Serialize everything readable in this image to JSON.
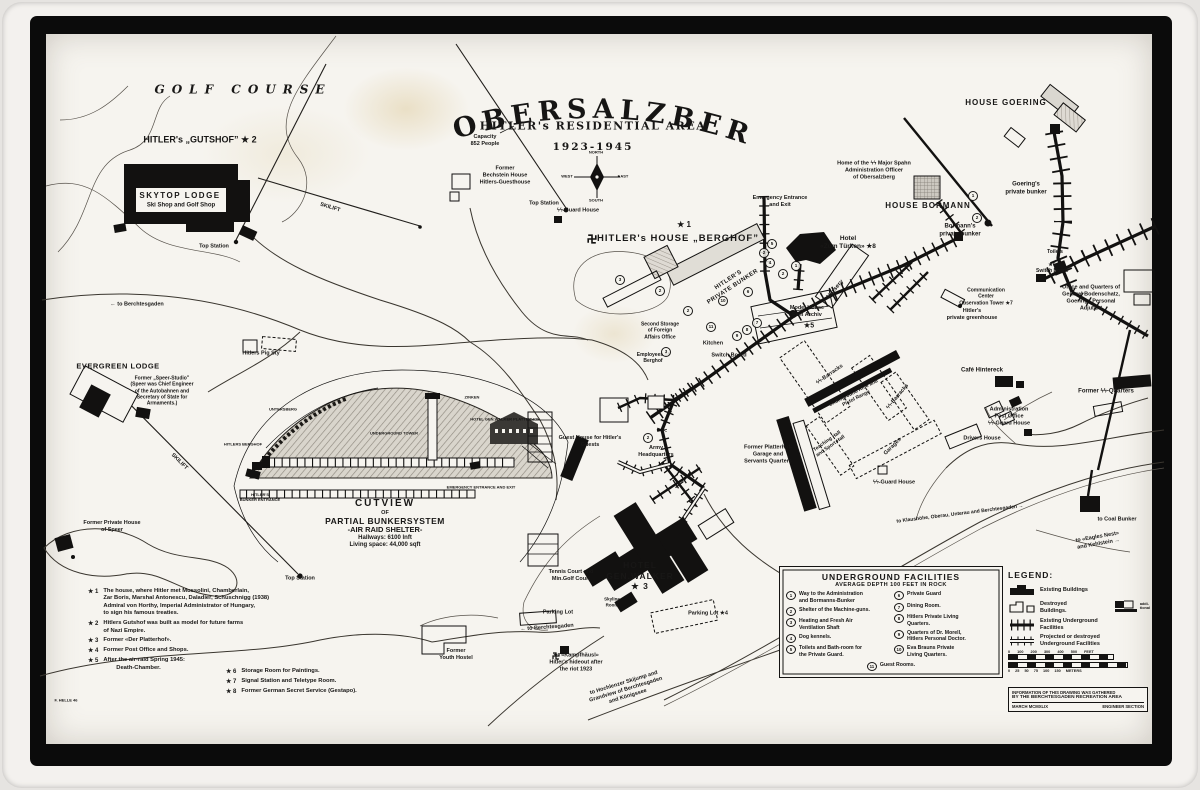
{
  "title": {
    "main": "OBERSALZBERG",
    "sub": "HITLER's RESIDENTIAL AREA",
    "years": "1923-1945"
  },
  "cutview": {
    "l1": "CUTVIEW",
    "l2": "OF",
    "l3": "PARTIAL BUNKERSYSTEM",
    "l4": "-AIR RAID SHELTER-",
    "l5": "Hallways: 6100 lnft",
    "l6": "Living space: 44,000 sqft"
  },
  "underground_facilities": {
    "title": "UNDERGROUND FACILITIES",
    "subtitle": "AVERAGE DEPTH 100 FEET IN ROCK",
    "left": [
      {
        "num": "1",
        "text": "Way to the Administration\nand Bormanns-Bunker"
      },
      {
        "num": "2",
        "text": "Shelter of the Machine-guns."
      },
      {
        "num": "3",
        "text": "Heating and Fresh Air\nVentilation Shaft"
      },
      {
        "num": "4",
        "text": "Dog kennels."
      },
      {
        "num": "5",
        "text": "Toilets and Bath-room for\nthe Private Guard."
      }
    ],
    "right": [
      {
        "num": "6",
        "text": "Private Guard"
      },
      {
        "num": "7",
        "text": "Dining Room."
      },
      {
        "num": "8",
        "text": "Hitlers Private Living\nQuarters."
      },
      {
        "num": "9",
        "text": "Quarters of Dr. Morell,\nHitlers Personal Doctor."
      },
      {
        "num": "10",
        "text": "Eva Brauns Private\nLiving Quarters."
      }
    ],
    "bottom": {
      "num": "11",
      "text": "Guest Rooms."
    }
  },
  "footnotes": {
    "left": [
      {
        "mark": "★ 1",
        "text": "The house, where Hitler met Mussolini, Chamberlain,\nZar Boris, Marshal Antonescu, Daladier, Schuschnigg (1938)\nAdmiral von Horthy, Imperial Administrator of Hungary,\nto sign his famous treaties."
      },
      {
        "mark": "★ 2",
        "text": "Hitlers Gutshof was built as model for future farms\nof Nazi Empire."
      },
      {
        "mark": "★ 3",
        "text": "Former «Der Platterhof»."
      },
      {
        "mark": "★ 4",
        "text": "Former Post Office and Shops."
      },
      {
        "mark": "★ 5",
        "text": "After the air-raid Spring 1945:\n        Death-Chamber."
      }
    ],
    "right": [
      {
        "mark": "★ 6",
        "text": "Storage Room for Paintings."
      },
      {
        "mark": "★ 7",
        "text": "Signal Station and Teletype Room."
      },
      {
        "mark": "★ 8",
        "text": "Former German Secret Service (Gestapo)."
      }
    ]
  },
  "legend": {
    "title": "LEGEND:",
    "existing": "Existing Buildings",
    "destroyed": "Destroyed\nBuildings.",
    "additional_note": "addi-\ntional",
    "underground": "Existing Underground\nFacilities",
    "projected": "Projected or destroyed\nUnderground Facilities",
    "scale_feet": "0 100 200 300 400 500 FEET",
    "scale_meters": "0 25 50 75 100 150 METERS"
  },
  "credit": {
    "line1": "INFORMATION OF THIS DRAWING WAS GATHERED",
    "line2": "BY THE BERCHTESGADEN RECREATION AREA",
    "line3_left": "MARCH MCMXLIX",
    "line3_right": "ENGINEER SECTION"
  },
  "map_labels": [
    {
      "n": "golf-course-label",
      "t": "GOLF COURSE",
      "x": 243,
      "y": 90,
      "s": 12,
      "ls": 7,
      "i": 1,
      "b": 1
    },
    {
      "n": "hitlers-gutshof-label",
      "t": "HITLER's „GUTSHOF” ★ 2",
      "x": 200,
      "y": 140,
      "s": 9,
      "b": 1
    },
    {
      "n": "skytop-lodge-label",
      "t": "SKYTOP LODGE",
      "x": 180,
      "y": 196,
      "s": 8,
      "b": 1,
      "ls": 1.5
    },
    {
      "n": "skytop-lodge-sub",
      "t": "Ski Shop and Golf Shop",
      "x": 181,
      "y": 206,
      "s": 6,
      "b": 1
    },
    {
      "n": "top-station-nw",
      "t": "Top Station",
      "x": 214,
      "y": 247,
      "s": 5.5
    },
    {
      "n": "skilift-ne-label",
      "t": "SKILIFT",
      "x": 330,
      "y": 208,
      "s": 5.5,
      "r": 17
    },
    {
      "n": "capacity-note",
      "t": "Capacity\n852 People",
      "x": 485,
      "y": 141,
      "s": 5.5
    },
    {
      "n": "bechstein-house-label",
      "t": "Former\nBechstein House\nHitlers-Guesthouse",
      "x": 505,
      "y": 176,
      "s": 5.5
    },
    {
      "n": "top-station-center",
      "t": "Top Station",
      "x": 544,
      "y": 204,
      "s": 5.5
    },
    {
      "n": "ss-guard-house-berghof",
      "t": "ϟϟ-Guard House",
      "x": 578,
      "y": 211,
      "s": 5.5
    },
    {
      "n": "berghof-star",
      "t": "★ 1",
      "x": 684,
      "y": 225,
      "s": 8,
      "b": 1
    },
    {
      "n": "berghof-label",
      "t": "HITLER's HOUSE „BERGHOF”",
      "x": 678,
      "y": 239,
      "s": 9.5,
      "b": 1,
      "ls": 1
    },
    {
      "n": "hitlers-private-bunker-label",
      "t": "HITLER'S\nPRIVATE BUNKER",
      "x": 731,
      "y": 284,
      "s": 6,
      "r": -33,
      "ls": 0.5
    },
    {
      "n": "emergency-entrance-label",
      "t": "Emergency Entrance\nand Exit",
      "x": 780,
      "y": 202,
      "s": 5.5
    },
    {
      "n": "spahn-home-label",
      "t": "Home of the ϟϟ Major Spahn\nAdministration Officer\nof Obersalzberg",
      "x": 874,
      "y": 171,
      "s": 5.5
    },
    {
      "n": "house-goering-label",
      "t": "HOUSE GOERING",
      "x": 1006,
      "y": 103,
      "s": 8,
      "b": 1,
      "ls": 1
    },
    {
      "n": "goerings-bunker-label",
      "t": "Goering's\nprivate bunker",
      "x": 1026,
      "y": 189,
      "s": 6
    },
    {
      "n": "house-bormann-label",
      "t": "HOUSE BORMANN",
      "x": 928,
      "y": 206,
      "s": 8,
      "b": 1,
      "ls": 1
    },
    {
      "n": "bormanns-bunker-label",
      "t": "Bormann's\nprivate bunker",
      "x": 960,
      "y": 231,
      "s": 6
    },
    {
      "n": "toilets-label",
      "t": "Toilets",
      "x": 1055,
      "y": 252,
      "s": 5
    },
    {
      "n": "switchboard-6-label",
      "t": "★6\nSwitch Board",
      "x": 1052,
      "y": 268,
      "s": 5
    },
    {
      "n": "bodenschatz-label",
      "t": "Office and Quarters of\nGeneral Bodenschatz,\nGoerings Personal\nAdjutant",
      "x": 1091,
      "y": 298,
      "s": 5.5
    },
    {
      "n": "hotel-zum-tuerken-label",
      "t": "Hotel\n«Zum Türken» ★8",
      "x": 848,
      "y": 243,
      "s": 6.5,
      "b": 1
    },
    {
      "n": "nursery-label",
      "t": "Nursery",
      "x": 836,
      "y": 290,
      "s": 6,
      "r": -50
    },
    {
      "n": "model-house-label",
      "t": "Model House\nFilm Archiv",
      "x": 807,
      "y": 312,
      "s": 5.5
    },
    {
      "n": "model-house-star",
      "t": "★5",
      "x": 809,
      "y": 327,
      "s": 7,
      "b": 1
    },
    {
      "n": "comm-center-label",
      "t": "Communication\nCenter\nObservation Tower ★7",
      "x": 986,
      "y": 297,
      "s": 5
    },
    {
      "n": "greenhouse-label",
      "t": "Hitler's\nprivate greenhouse",
      "x": 972,
      "y": 315,
      "s": 5.5
    },
    {
      "n": "second-storage-label",
      "t": "Second Storage\nof Foreign\nAffairs Office",
      "x": 660,
      "y": 331,
      "s": 5
    },
    {
      "n": "employees-label",
      "t": "Employees of\nBerghof",
      "x": 653,
      "y": 358,
      "s": 5
    },
    {
      "n": "kitchen-label",
      "t": "Kitchen",
      "x": 713,
      "y": 344,
      "s": 5.5
    },
    {
      "n": "switchboard-center-label",
      "t": "Switch Board",
      "x": 729,
      "y": 356,
      "s": 5.5
    },
    {
      "n": "ss-barracks-1-label",
      "t": "ϟϟ-Barracks",
      "x": 830,
      "y": 375,
      "s": 5.5,
      "r": -35
    },
    {
      "n": "rifle-range-label",
      "t": "Underground Rifle and\nPistol Range",
      "x": 855,
      "y": 396,
      "s": 5,
      "r": -27
    },
    {
      "n": "ss-barracks-2-label",
      "t": "ϟϟ-Barracks",
      "x": 898,
      "y": 397,
      "s": 5.5,
      "r": -50
    },
    {
      "n": "teaching-hall-label",
      "t": "Teaching Hall\nand Sport Hall",
      "x": 829,
      "y": 444,
      "s": 5,
      "r": -35
    },
    {
      "n": "garages-label",
      "t": "Garages",
      "x": 893,
      "y": 447,
      "s": 5.5,
      "r": -45
    },
    {
      "n": "ss-guard-house-s-label",
      "t": "ϟϟ-Guard House",
      "x": 894,
      "y": 483,
      "s": 5.5
    },
    {
      "n": "cafe-hintereck-label",
      "t": "Café Hintereck",
      "x": 982,
      "y": 371,
      "s": 6
    },
    {
      "n": "former-ss-quarters-label",
      "t": "Former ϟϟ-Quarters",
      "x": 1106,
      "y": 392,
      "s": 6
    },
    {
      "n": "administration-label",
      "t": "Administration\nPost Office\nϟϟ-Guard House",
      "x": 1009,
      "y": 417,
      "s": 5.5
    },
    {
      "n": "drivers-house-label",
      "t": "Drivers House",
      "x": 982,
      "y": 439,
      "s": 5.5
    },
    {
      "n": "guest-house-label",
      "t": "Guest House for Hitler's\nGuests",
      "x": 590,
      "y": 442,
      "s": 5.5
    },
    {
      "n": "army-hq-label",
      "t": "Army\nHeadquarters",
      "x": 656,
      "y": 452,
      "s": 5.5
    },
    {
      "n": "platterhof-garage-label",
      "t": "Former Platterhof-\nGarage and\nServants Quarters",
      "x": 768,
      "y": 455,
      "s": 5.5
    },
    {
      "n": "pig-sty-label",
      "t": "Hitlers Pig Sty",
      "x": 261,
      "y": 354,
      "s": 5.5
    },
    {
      "n": "to-berchtesgaden-w",
      "t": "← to Berchtesgaden",
      "x": 137,
      "y": 305,
      "s": 5.5
    },
    {
      "n": "evergreen-lodge-label",
      "t": "EVERGREEN LODGE",
      "x": 118,
      "y": 366,
      "s": 7.5,
      "b": 1,
      "ls": 0.5
    },
    {
      "n": "speer-studio-note",
      "t": "Former „Speer-Studio”\n(Speer was Chief Engineer\nof the Autobahnen and\nSecretary of State for\nArmaments.)",
      "x": 162,
      "y": 391,
      "s": 5
    },
    {
      "n": "skilift-sw-label",
      "t": "SKILIFT",
      "x": 179,
      "y": 462,
      "s": 5.5,
      "r": 45
    },
    {
      "n": "speer-house-label",
      "t": "Former Private House\nof Speer",
      "x": 112,
      "y": 527,
      "s": 5.5
    },
    {
      "n": "top-station-sw",
      "t": "Top Station",
      "x": 300,
      "y": 579,
      "s": 5.5
    },
    {
      "n": "cutview-untersberg",
      "t": "UNTERSBERG",
      "x": 283,
      "y": 409,
      "s": 4
    },
    {
      "n": "cutview-berghof",
      "t": "HITLERS BERGHOF",
      "x": 243,
      "y": 444,
      "s": 4
    },
    {
      "n": "cutview-tower",
      "t": "UNDERGROUND TOWER",
      "x": 394,
      "y": 433,
      "s": 4
    },
    {
      "n": "cutview-zinken",
      "t": "ZINKEN",
      "x": 472,
      "y": 397,
      "s": 4
    },
    {
      "n": "cutview-platterhof",
      "t": "HOTEL GEN.WALKER PLATTERHOF",
      "x": 505,
      "y": 419,
      "s": 4
    },
    {
      "n": "cutview-emergency",
      "t": "EMERGENCY ENTRANCE AND EXIT",
      "x": 481,
      "y": 487,
      "s": 4
    },
    {
      "n": "cutview-entrance",
      "t": "HITLER'S\nBUNKER ENTRANCE",
      "x": 260,
      "y": 497,
      "s": 4
    },
    {
      "n": "hotel-genwalker-label",
      "t": "HOTEL\nGEN.WALKER\n★ 3",
      "x": 640,
      "y": 576,
      "s": 8.5,
      "b": 1,
      "ls": 1
    },
    {
      "n": "tennis-court-label",
      "t": "Tennis Court and\nMin.Golf Court",
      "x": 571,
      "y": 576,
      "s": 5.5
    },
    {
      "n": "skyline-room-label",
      "t": "Skyline\nRoom",
      "x": 612,
      "y": 602,
      "s": 4.5
    },
    {
      "n": "parking-lot-w",
      "t": "Parking Lot",
      "x": 558,
      "y": 613,
      "s": 5.5
    },
    {
      "n": "to-berchtesgaden-s",
      "t": "← to Berchtesgaden",
      "x": 547,
      "y": 628,
      "s": 5.5,
      "r": -4
    },
    {
      "n": "youth-hostel-label",
      "t": "Former\nYouth Hostel",
      "x": 456,
      "y": 655,
      "s": 5.5
    },
    {
      "n": "kampfhaeusl-label",
      "t": "★  «Kampfhäusl»\nHitler's hideout after\nthe riot 1923",
      "x": 576,
      "y": 663,
      "s": 5.5
    },
    {
      "n": "parking-lot-4",
      "t": "Parking Lot ★4",
      "x": 708,
      "y": 614,
      "s": 5.5
    },
    {
      "n": "hochlenzer-road-label",
      "t": "to Hochlenzer Skijump and\nGrandview of Berchtesgaden\nand Königssee",
      "x": 626,
      "y": 690,
      "s": 5.5,
      "r": -17
    },
    {
      "n": "klaushoehe-road-label",
      "t": "to Klaushöhe, Oberau, Unterau and Berchtesgaden →",
      "x": 960,
      "y": 514,
      "s": 5,
      "r": -7
    },
    {
      "n": "coal-bunker-label",
      "t": "to Coal Bunker",
      "x": 1117,
      "y": 520,
      "s": 5.5
    },
    {
      "n": "eagles-nest-label",
      "t": "to «Eagles Nest»\nand Kehlstein →",
      "x": 1098,
      "y": 541,
      "s": 5.5,
      "r": -10
    },
    {
      "n": "signature",
      "t": "F. HELLE 46",
      "x": 66,
      "y": 700,
      "s": 4
    },
    {
      "n": "compass-north",
      "t": "NORTH",
      "x": 596,
      "y": 152,
      "s": 4
    },
    {
      "n": "compass-west",
      "t": "WEST",
      "x": 567,
      "y": 176,
      "s": 4
    },
    {
      "n": "compass-east",
      "t": "EAST",
      "x": 623,
      "y": 176,
      "s": 4
    },
    {
      "n": "compass-south",
      "t": "SOUTH",
      "x": 596,
      "y": 200,
      "s": 4
    }
  ],
  "bunker_numbers": [
    {
      "n": "5",
      "x": 772,
      "y": 244
    },
    {
      "n": "2",
      "x": 764,
      "y": 253
    },
    {
      "n": "4",
      "x": 770,
      "y": 263
    },
    {
      "n": "3",
      "x": 620,
      "y": 280
    },
    {
      "n": "2",
      "x": 660,
      "y": 291
    },
    {
      "n": "2",
      "x": 688,
      "y": 311
    },
    {
      "n": "10",
      "x": 723,
      "y": 301
    },
    {
      "n": "6",
      "x": 748,
      "y": 292
    },
    {
      "n": "7",
      "x": 757,
      "y": 323
    },
    {
      "n": "8",
      "x": 747,
      "y": 330
    },
    {
      "n": "9",
      "x": 737,
      "y": 336
    },
    {
      "n": "11",
      "x": 711,
      "y": 327
    },
    {
      "n": "1",
      "x": 973,
      "y": 196
    },
    {
      "n": "2",
      "x": 977,
      "y": 218
    },
    {
      "n": "2",
      "x": 648,
      "y": 438
    },
    {
      "n": "3",
      "x": 666,
      "y": 352
    },
    {
      "n": "1",
      "x": 796,
      "y": 266
    },
    {
      "n": "2",
      "x": 783,
      "y": 274
    }
  ]
}
